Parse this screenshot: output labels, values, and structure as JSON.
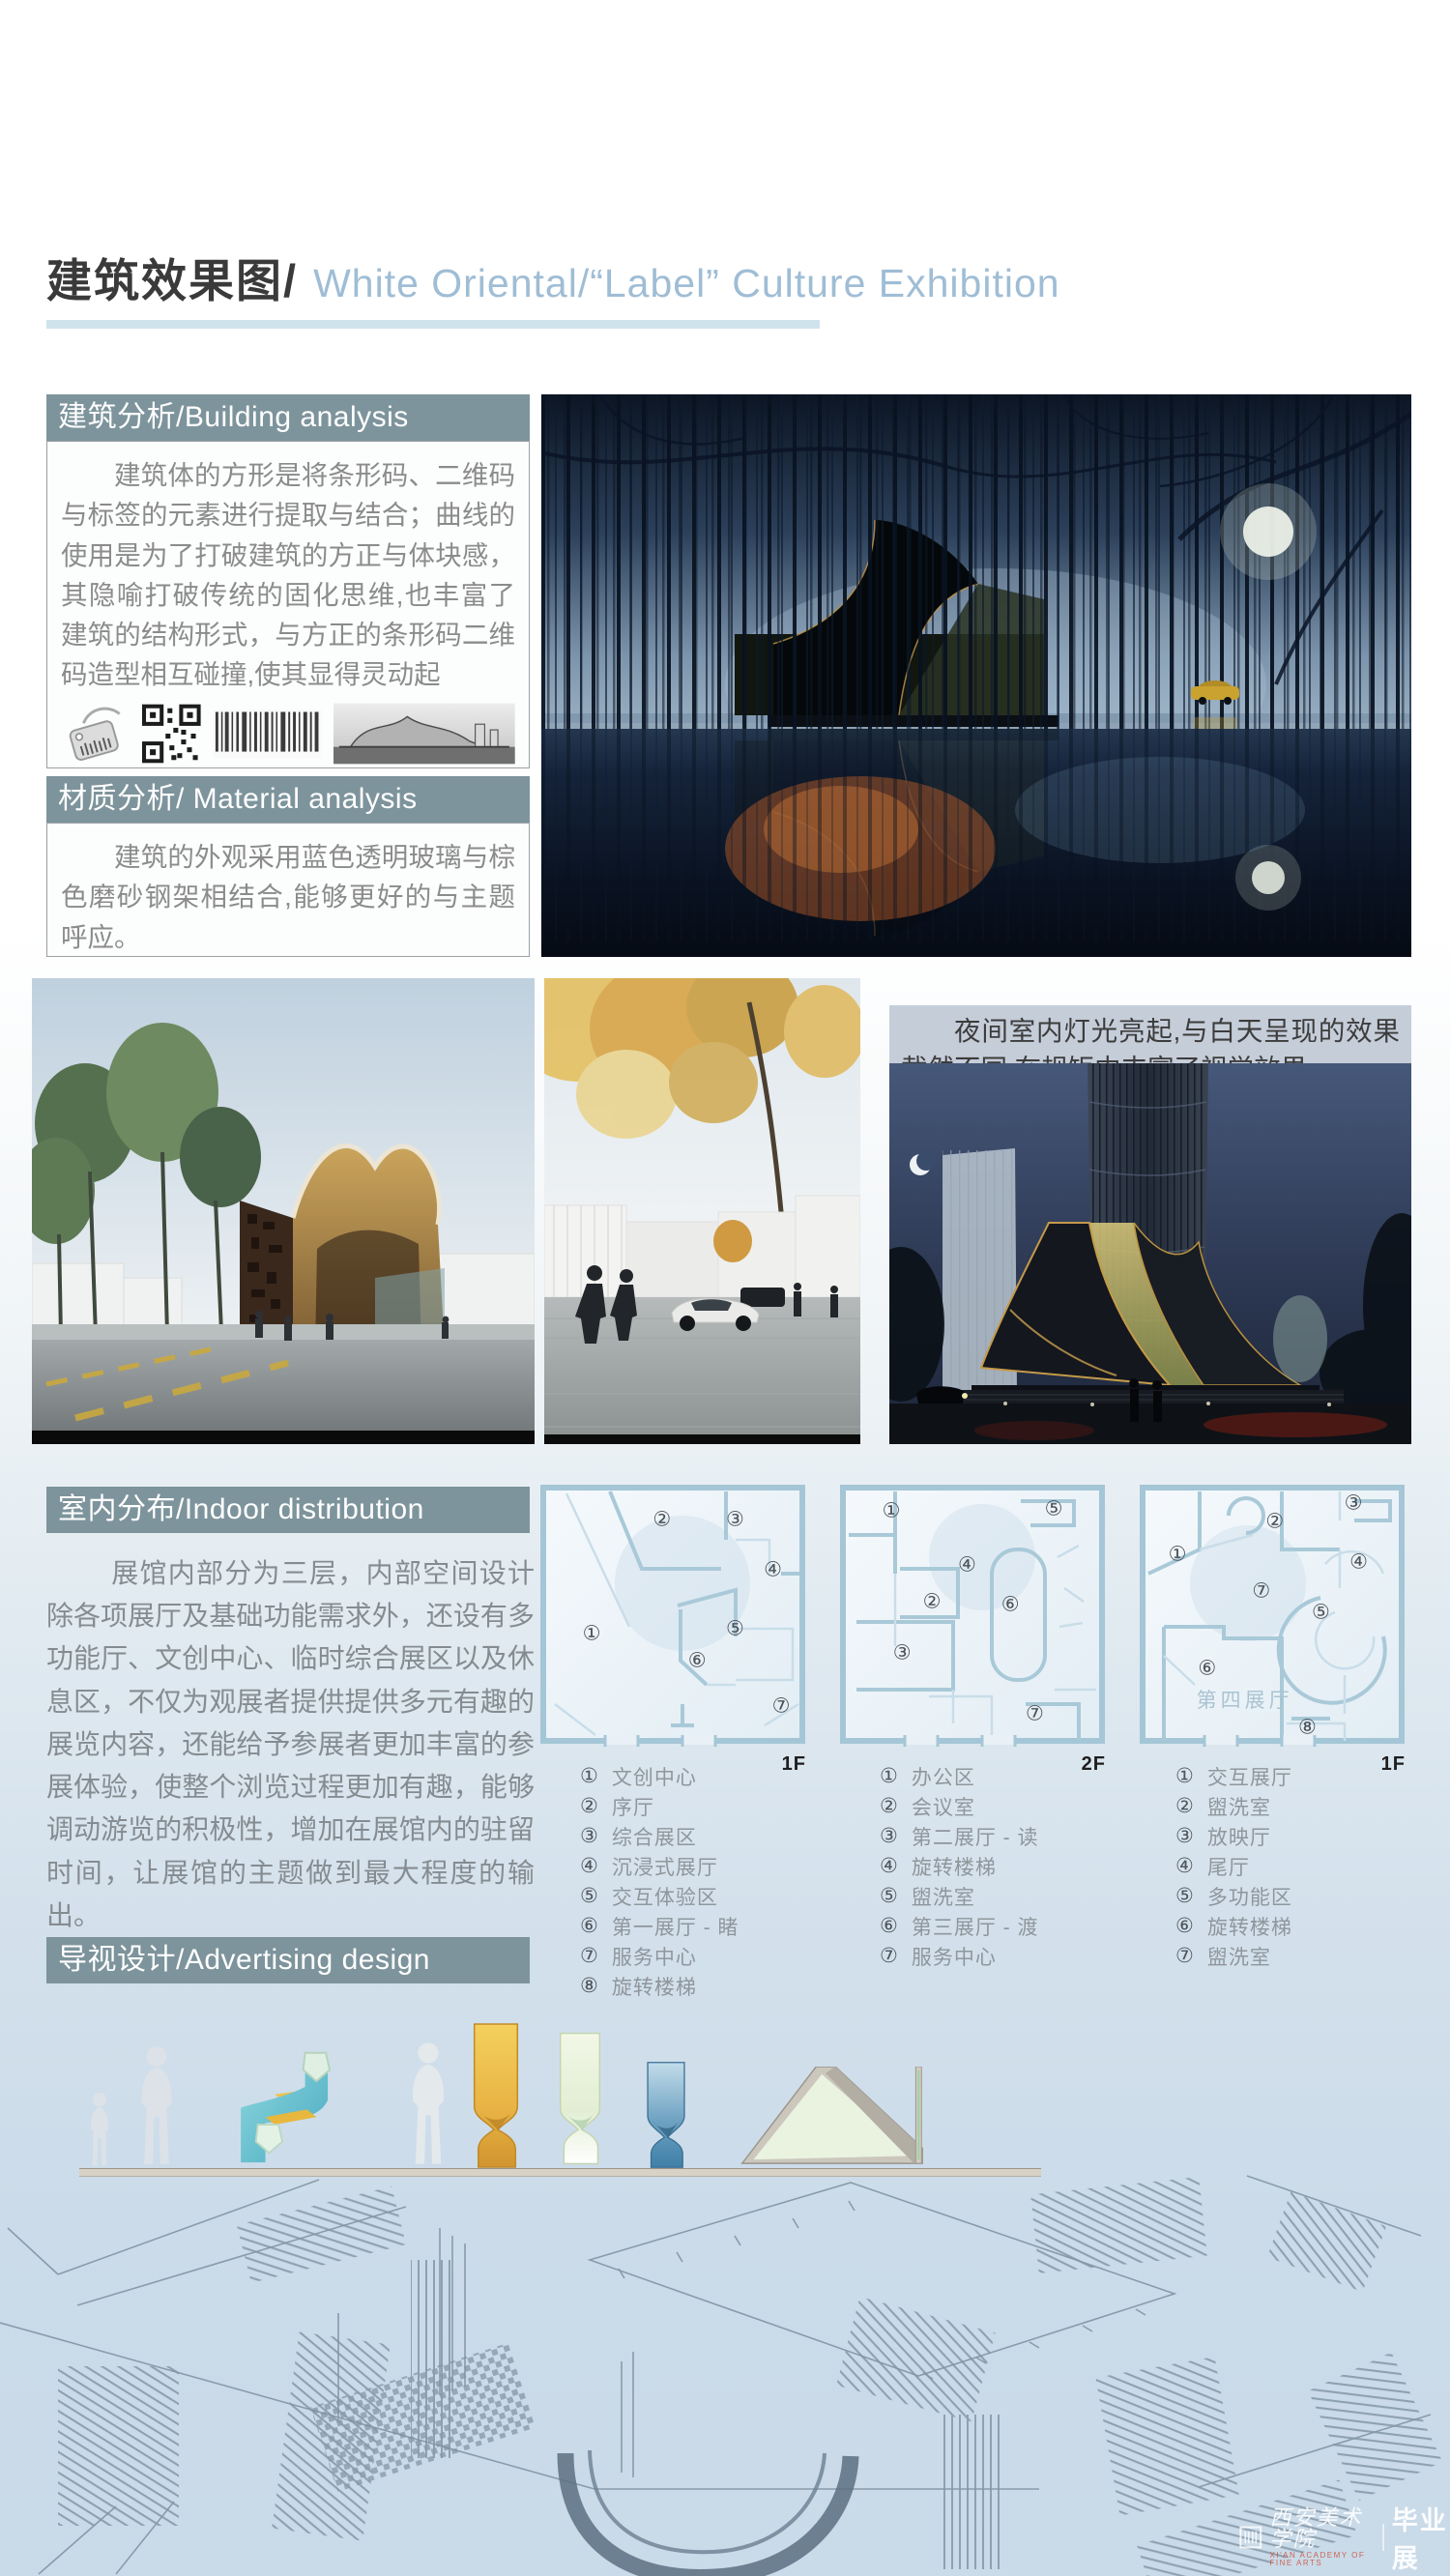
{
  "header": {
    "title_zh": "建筑效果图/",
    "title_en": "White Oriental/“Label” Culture Exhibition"
  },
  "sections": {
    "building_analysis": {
      "header": "建筑分析/Building analysis",
      "body": "建筑体的方形是将条形码、二维码与标签的元素进行提取与结合；曲线的使用是为了打破建筑的方正与体块感，其隐喻打破传统的固化思维,也丰富了建筑的结构形式，与方正的条形码二维码造型相互碰撞,使其显得灵动起",
      "icons": [
        "tag-icon",
        "qr-code-icon",
        "barcode-icon",
        "concept-sketch-image"
      ]
    },
    "material_analysis": {
      "header": "材质分析/ Material analysis",
      "body": "建筑的外观采用蓝色透明玻璃与棕色磨砂钢架相结合,能够更好的与主题呼应。"
    },
    "indoor": {
      "header": "室内分布/Indoor distribution",
      "body": "展馆内部分为三层，内部空间设计除各项展厅及基础功能需求外，还设有多功能厅、文创中心、临时综合展区以及休息区，不仅为观展者提供提供多元有趣的展览内容，还能给予参展者更加丰富的参展体验，使整个浏览过程更加有趣，能够调动游览的积极性，增加在展馆内的驻留时间，让展馆的主题做到最大程度的输出。",
      "plans": [
        {
          "floor": "1F",
          "markers": [
            "①",
            "②",
            "③",
            "④",
            "⑤",
            "⑥",
            "⑦"
          ],
          "legend": [
            {
              "num": "①",
              "label": "文创中心"
            },
            {
              "num": "②",
              "label": "序厅"
            },
            {
              "num": "③",
              "label": "综合展区"
            },
            {
              "num": "④",
              "label": "沉浸式展厅"
            },
            {
              "num": "⑤",
              "label": "交互体验区"
            },
            {
              "num": "⑥",
              "label": "第一展厅 - 睹"
            },
            {
              "num": "⑦",
              "label": "服务中心"
            },
            {
              "num": "⑧",
              "label": "旋转楼梯"
            }
          ]
        },
        {
          "floor": "2F",
          "markers": [
            "①",
            "②",
            "③",
            "④",
            "⑤",
            "⑥",
            "⑦"
          ],
          "legend": [
            {
              "num": "①",
              "label": "办公区"
            },
            {
              "num": "②",
              "label": "会议室"
            },
            {
              "num": "③",
              "label": "第二展厅 - 读"
            },
            {
              "num": "④",
              "label": "旋转楼梯"
            },
            {
              "num": "⑤",
              "label": "盥洗室"
            },
            {
              "num": "⑥",
              "label": "第三展厅 - 渡"
            },
            {
              "num": "⑦",
              "label": "服务中心"
            }
          ]
        },
        {
          "floor": "1F",
          "room_label": "第四展厅",
          "markers": [
            "①",
            "②",
            "③",
            "④",
            "⑤",
            "⑥",
            "⑦",
            "⑧"
          ],
          "legend": [
            {
              "num": "①",
              "label": "交互展厅"
            },
            {
              "num": "②",
              "label": "盥洗室"
            },
            {
              "num": "③",
              "label": "放映厅"
            },
            {
              "num": "④",
              "label": "尾厅"
            },
            {
              "num": "⑤",
              "label": "多功能区"
            },
            {
              "num": "⑥",
              "label": "旋转楼梯"
            },
            {
              "num": "⑦",
              "label": "盥洗室"
            }
          ]
        }
      ]
    },
    "advertising": {
      "header": "导视设计/Advertising design"
    }
  },
  "captions": {
    "night_view": "夜间室内灯光亮起,与白天呈现的效果截然不同,在规矩中丰富了视觉效果。"
  },
  "images": {
    "hero": "night-forest-building-render",
    "day_building": "daytime-building-render",
    "street_view": "street-view-render",
    "night_city": "night-city-building-render"
  },
  "watermark": {
    "school": "西安美术学院",
    "school_sub": "XI'AN ACADEMY OF FINE ARTS",
    "exhibition": "毕业展",
    "url": "xafa.meishu.org.cn"
  },
  "colors": {
    "section_header_bg": "#7e949c",
    "title_en": "#9fbdd5",
    "underline": "#cfe3ed",
    "caption_bg": "#c5cdd9",
    "page_bottom": "#c9dae8",
    "plan_wall": "#a5c6d6"
  }
}
